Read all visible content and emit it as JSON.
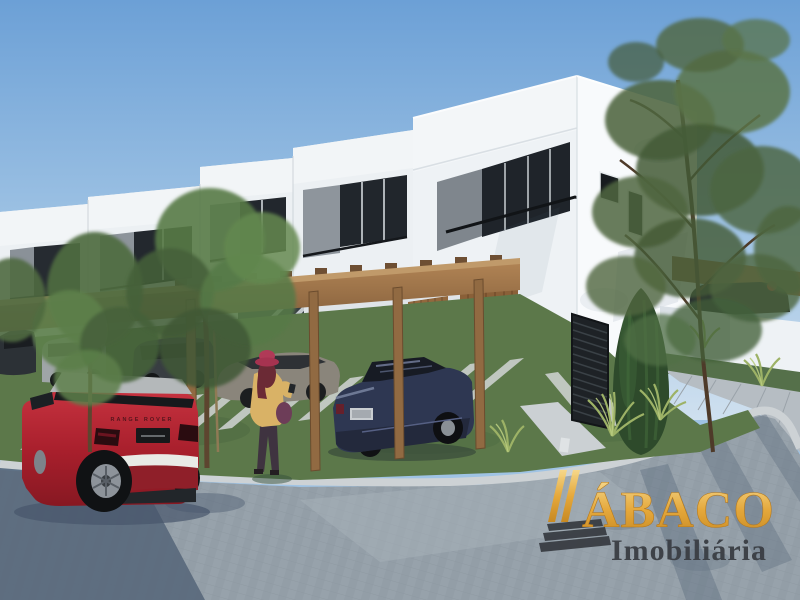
{
  "scene": {
    "setting": "street-corner 3D rendering of a row of modern two-story white townhouses with wood pergola carports",
    "sky": "clear blue sky",
    "figures": "woman with red hat standing on the lawn path",
    "vehicles": [
      "red compact SUV in foreground street",
      "dark blue sedan under carport",
      "gray sedan",
      "silver minivan",
      "dark SUV"
    ]
  },
  "watermark": {
    "brand": "ÁBACO",
    "tagline": "Imobiliária",
    "brand_color": "#E9A63B",
    "tagline_color": "#3E4147",
    "icon": "abacus-bars-icon"
  },
  "vehicles": {
    "red_suv_badge": "RANGE ROVER"
  },
  "palette": {
    "sky_top": "#6CA0D6",
    "sky_bottom": "#C9DCEE",
    "wall_white": "#F2F5F7",
    "accent_gray": "#858C93",
    "glass_dark": "#22272D",
    "wood": "#A0754A",
    "grass": "#5C784A",
    "street": "#97A2AB",
    "street_shadow": "#5A6A7C",
    "sidewalk": "#B9C0C6",
    "car_red": "#B22430",
    "car_blue": "#2E3752"
  }
}
